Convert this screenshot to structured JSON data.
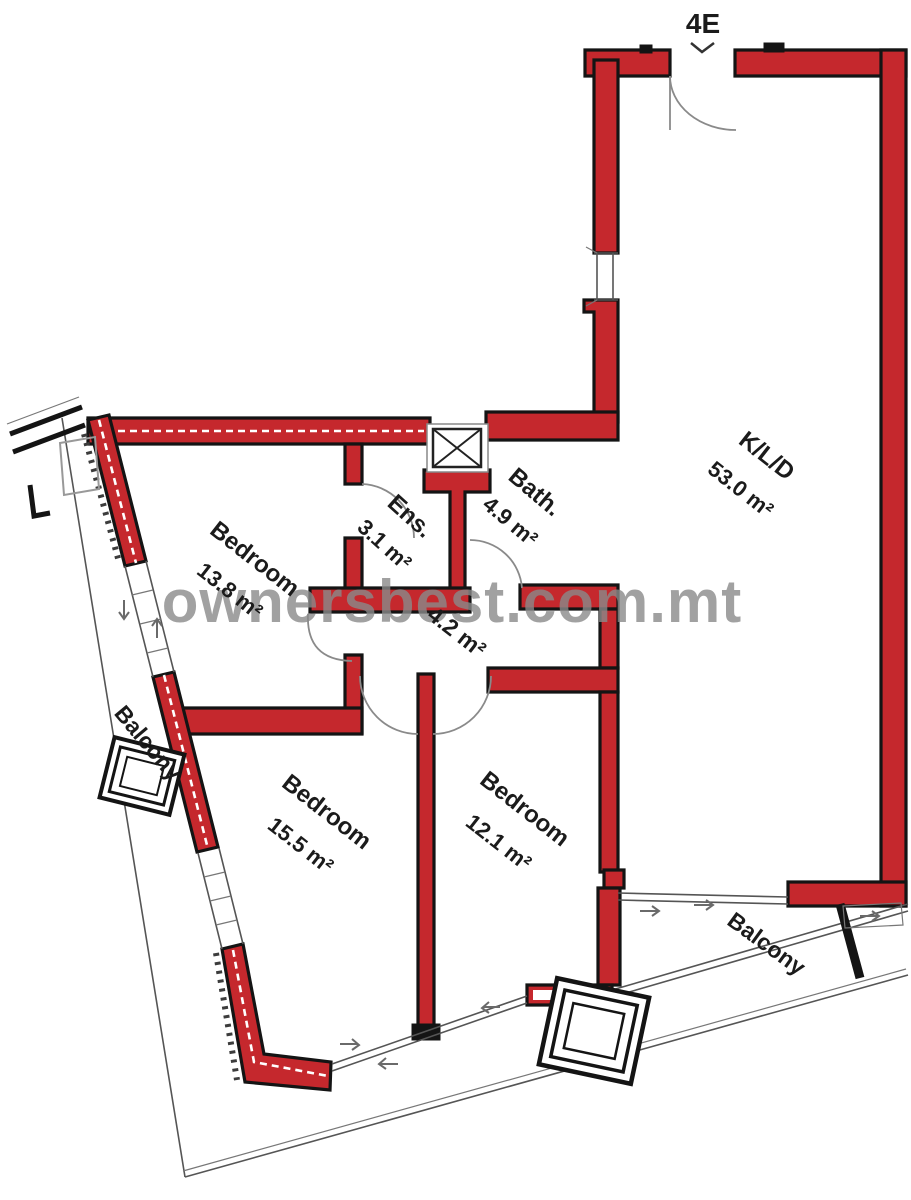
{
  "unit": {
    "label": "4E"
  },
  "watermark": {
    "text": "ownersbest.com.mt"
  },
  "rooms": [
    {
      "name": "K/L/D",
      "area": "53.0 m²"
    },
    {
      "name": "Bath.",
      "area": "4.9 m²"
    },
    {
      "name": "Ens.",
      "area": "3.1 m²"
    },
    {
      "name": "Bedroom",
      "area": "13.8 m²"
    },
    {
      "name": "Bedroom",
      "area": "15.5 m²"
    },
    {
      "name": "Bedroom",
      "area": "12.1 m²"
    },
    {
      "name": "",
      "area": "4.2 m²"
    }
  ],
  "balconies": [
    {
      "label": "Balcony"
    },
    {
      "label": "Balcony"
    }
  ],
  "colors": {
    "wall_fill": "#c5282d",
    "wall_outline": "#141414",
    "watermark_gray": "#8a8a8a"
  }
}
